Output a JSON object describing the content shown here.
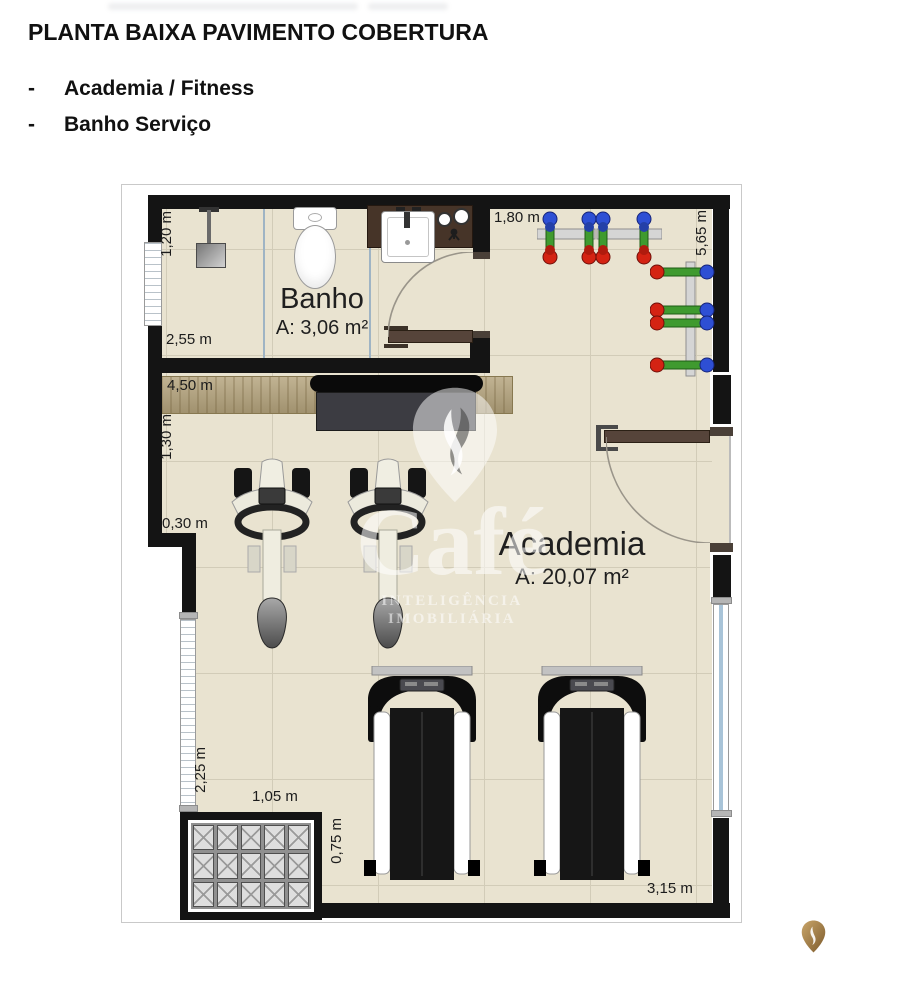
{
  "header": {
    "title": "PLANTA BAIXA PAVIMENTO COBERTURA",
    "bullets": [
      {
        "dash": "-",
        "label": "Academia / Fitness"
      },
      {
        "dash": "-",
        "label": "Banho Serviço"
      }
    ]
  },
  "plan": {
    "rooms": [
      {
        "name": "Banho",
        "area": "A: 3,06 m²"
      },
      {
        "name": "Academia",
        "area": "A: 20,07 m²"
      }
    ],
    "dims": {
      "d120": "1,20 m",
      "d255": "2,55 m",
      "d450": "4,50 m",
      "d130": "1,30 m",
      "d030": "0,30 m",
      "d180": "1,80 m",
      "d565": "5,65 m",
      "d225": "2,25 m",
      "d105": "1,05 m",
      "d075": "0,75 m",
      "d315": "3,15 m"
    }
  },
  "watermark": {
    "brand": "Café",
    "tagline": "INTELIGÊNCIA IMOBILIÁRIA"
  },
  "colors": {
    "wall": "#141414",
    "floor": "#e9e3d0",
    "wood": "#b3a27b",
    "accent_gold": "#b08d4f",
    "dumbbell_blue": "#2e4fd4",
    "dumbbell_green": "#3f9a2f",
    "dumbbell_red": "#d42313"
  }
}
